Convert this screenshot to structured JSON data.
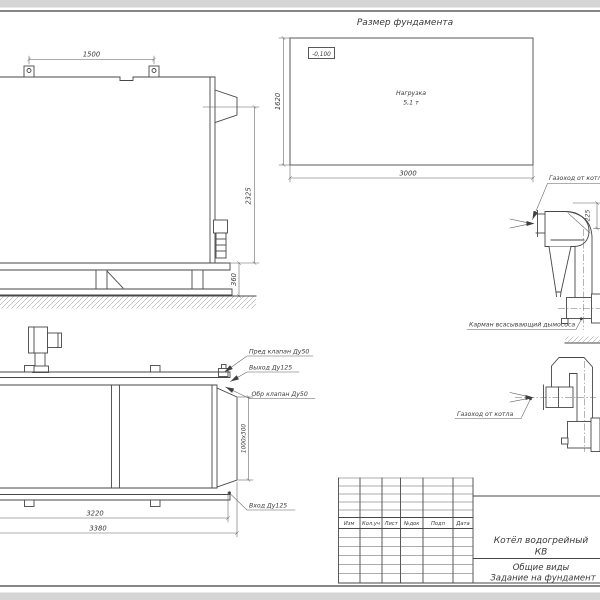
{
  "foundation_plan": {
    "title": "Размер фундамента",
    "elevation_mark": "-0,100",
    "load_label": "Нагрузка",
    "load_value": "5,1 т",
    "dim_width": "3000",
    "dim_depth": "1620"
  },
  "side_view": {
    "dim_lug_spacing": "1500",
    "dim_height": "2325",
    "dim_base_height": "360"
  },
  "top_view": {
    "safety_valve_label": "Пред клапан Ду50",
    "outlet_label": "Выход Ду125",
    "check_valve_label": "Обр клапан Ду50",
    "inlet_label": "Вход Ду125",
    "flue_outlet_dim": "1000x300",
    "dim_length": "3220",
    "dim_overall_length": "3380"
  },
  "exhauster_view": {
    "duct_label": "Газоход от котла",
    "pocket_label": "Карман всасывающий дымососа",
    "dim_offset": "225"
  },
  "duct_view": {
    "duct_label": "Газоход от котла"
  },
  "title_block": {
    "columns": [
      "Изм",
      "Кол.уч",
      "Лист",
      "№док",
      "Подп",
      "Дата"
    ],
    "product_name_line1": "Котёл водогрейный",
    "product_name_line2": "КВ",
    "doc_type": "Общие виды",
    "sheet_title": "Задание на фундамент"
  },
  "colors": {
    "line": "#474747",
    "background": "#ffffff",
    "margin_band": "#d5d5d5"
  }
}
